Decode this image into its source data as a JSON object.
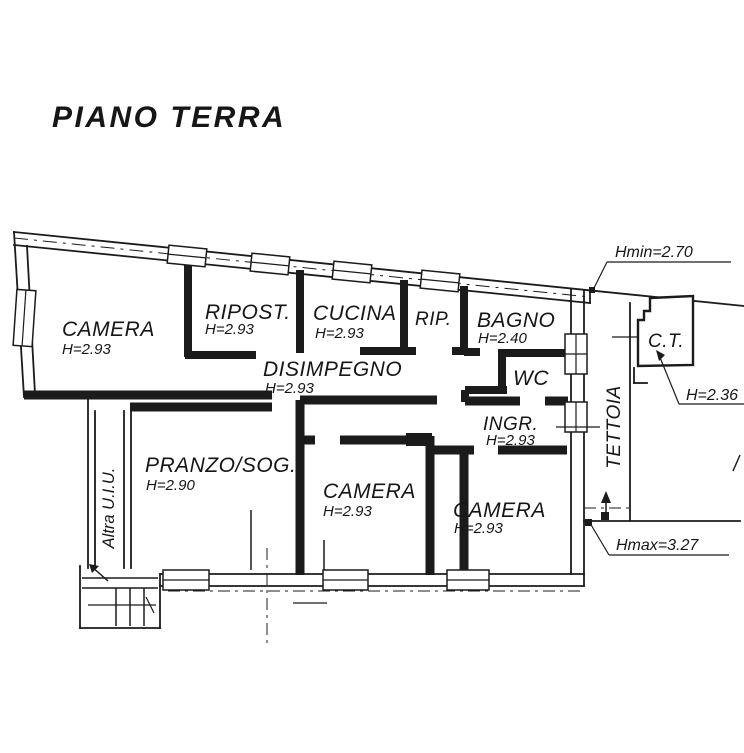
{
  "title": "PIANO TERRA",
  "rooms": {
    "camera_nw": {
      "label": "CAMERA",
      "height": "H=2.93"
    },
    "ripostiglio": {
      "label": "RIPOST.",
      "height": "H=2.93"
    },
    "cucina": {
      "label": "CUCINA",
      "height": "H=2.93"
    },
    "rip": {
      "label": "RIP."
    },
    "bagno": {
      "label": "BAGNO",
      "height": "H=2.40"
    },
    "wc": {
      "label": "WC"
    },
    "disimpegno": {
      "label": "DISIMPEGNO",
      "height": "H=2.93"
    },
    "pranzo_soggiorno": {
      "label": "PRANZO/SOG.",
      "height": "H=2.90"
    },
    "camera_center": {
      "label": "CAMERA",
      "height": "H=2.93"
    },
    "camera_se": {
      "label": "CAMERA",
      "height": "H=2.93"
    },
    "ingresso": {
      "label": "INGR.",
      "height": "H=2.93"
    },
    "tettoia": {
      "label": "TETTOIA"
    },
    "centrale_termica": {
      "label": "C.T."
    },
    "altra_uiu": {
      "label": "Altra U.I.U."
    }
  },
  "annotations": {
    "hmin": {
      "label": "Hmin=2.70"
    },
    "h_ct": {
      "label": "H=2.36"
    },
    "hmax": {
      "label": "Hmax=3.27"
    }
  },
  "colors": {
    "ink": "#1b1b1b",
    "paper": "#ffffff"
  }
}
